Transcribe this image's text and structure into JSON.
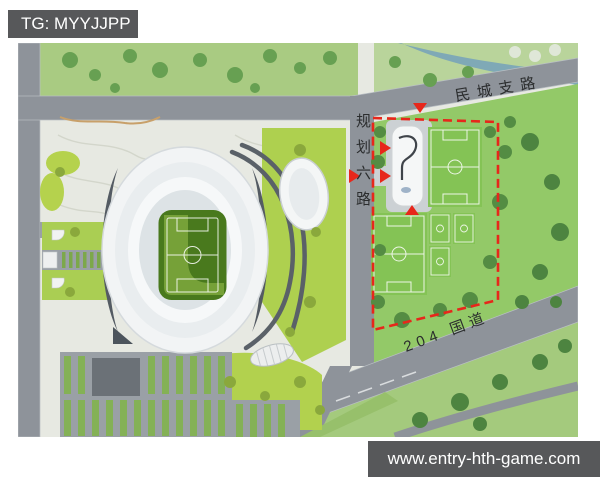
{
  "watermarks": {
    "tg_label": "TG: MYYJJPP",
    "site_url": "www.entry-hth-game.com",
    "box_color": "#57585a",
    "text_color": "#ffffff"
  },
  "map": {
    "kind": "stadium masterplan aerial rendering",
    "road_labels": [
      {
        "id": "mincheng-zhilu",
        "text": "民城支路"
      },
      {
        "id": "guihua-liulu",
        "text": "规划六路"
      },
      {
        "id": "guodao-204",
        "text": "204 国道"
      }
    ],
    "colors": {
      "boundary_dash_red": "#e7271b",
      "road_gray": "#8e939a",
      "stadium_roof_white": "#f2f4f5",
      "stadium_pitch_green": "#49791d",
      "training_grass_green": "#93c968",
      "park_green": "#a9cb82",
      "landscape_yellow_green": "#b5d24d",
      "river_blue": "#7fa9b6",
      "plaza_gray": "#e7e9e2"
    }
  }
}
